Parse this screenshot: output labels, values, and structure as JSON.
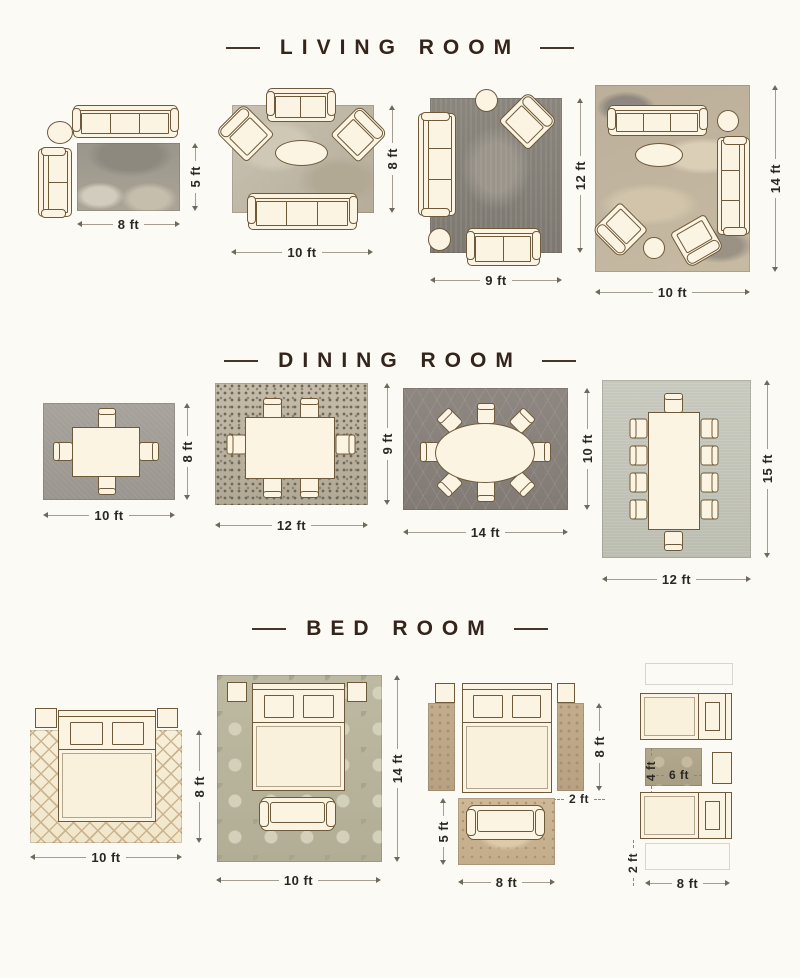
{
  "page": {
    "background": "#fcfaf4"
  },
  "colors": {
    "title": "#33241c",
    "dimension_label": "#2b2722",
    "furniture_fill": "#fbf4e2",
    "furniture_outline": "#6e5a3a",
    "dimension_line": "#a49e91"
  },
  "sections": {
    "living": {
      "title": "LIVING ROOM",
      "layouts": [
        {
          "w": "8 ft",
          "h": "5 ft"
        },
        {
          "w": "10 ft",
          "h": "8 ft"
        },
        {
          "w": "9 ft",
          "h": "12 ft"
        },
        {
          "w": "10 ft",
          "h": "14 ft"
        }
      ]
    },
    "dining": {
      "title": "DINING ROOM",
      "layouts": [
        {
          "w": "10 ft",
          "h": "8 ft"
        },
        {
          "w": "12 ft",
          "h": "9 ft"
        },
        {
          "w": "14 ft",
          "h": "10 ft"
        },
        {
          "w": "12 ft",
          "h": "15 ft"
        }
      ]
    },
    "bed": {
      "title": "BED ROOM",
      "layouts": [
        {
          "w": "10 ft",
          "h": "8 ft"
        },
        {
          "w": "10 ft",
          "h": "14 ft"
        },
        {
          "runner_h": "8 ft",
          "runner_w": "2 ft",
          "bench_rug_h": "5 ft",
          "bench_rug_w": "8 ft"
        },
        {
          "small_rug_h": "4 ft",
          "small_rug_w": "6 ft",
          "runner_w": "2 ft",
          "runner_rug_w": "8 ft"
        }
      ]
    }
  }
}
